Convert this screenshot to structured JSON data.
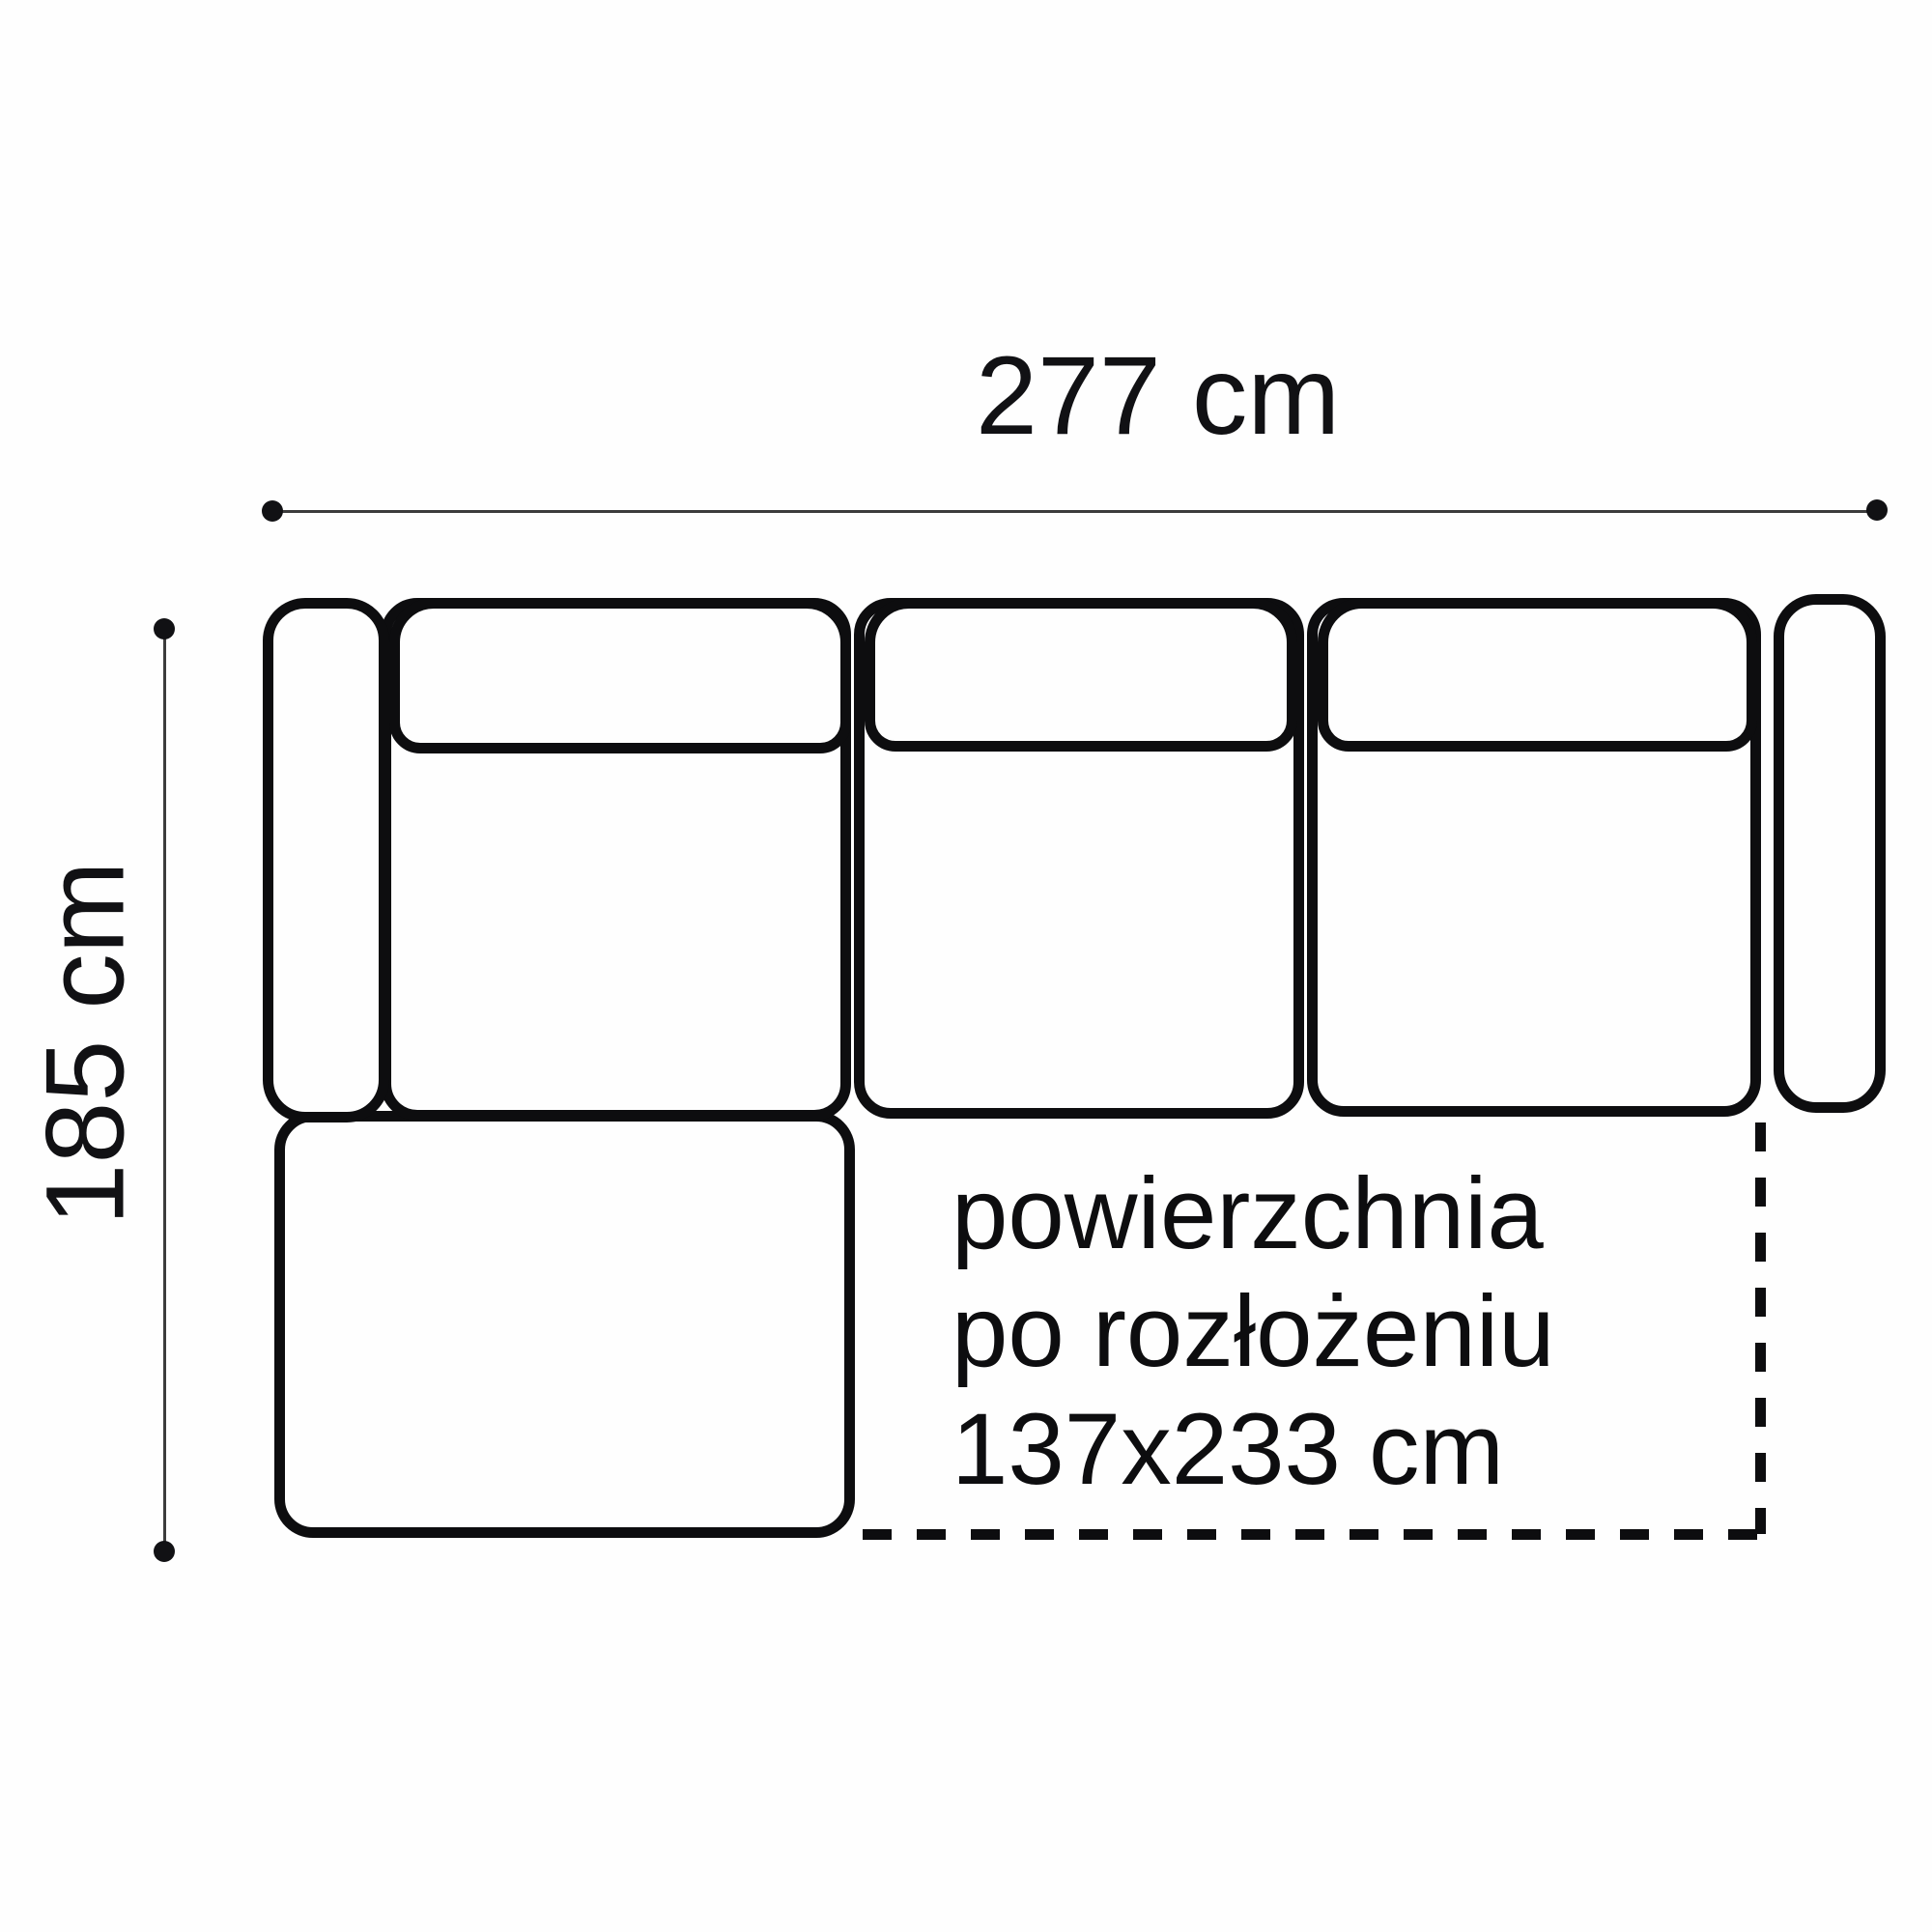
{
  "diagram": {
    "title": "corner sofa top-view dimension drawing",
    "dimensions": {
      "width": {
        "label": "277 cm"
      },
      "height": {
        "label": "185 cm"
      }
    },
    "unfolded_note": {
      "line1": "powierzchnia",
      "line2": "po rozłożeniu",
      "line3": "137x233 cm"
    },
    "colors": {
      "ink": "#0d0d0f",
      "dimension_line": "#3c3c3c",
      "background": "#ffffff"
    }
  }
}
